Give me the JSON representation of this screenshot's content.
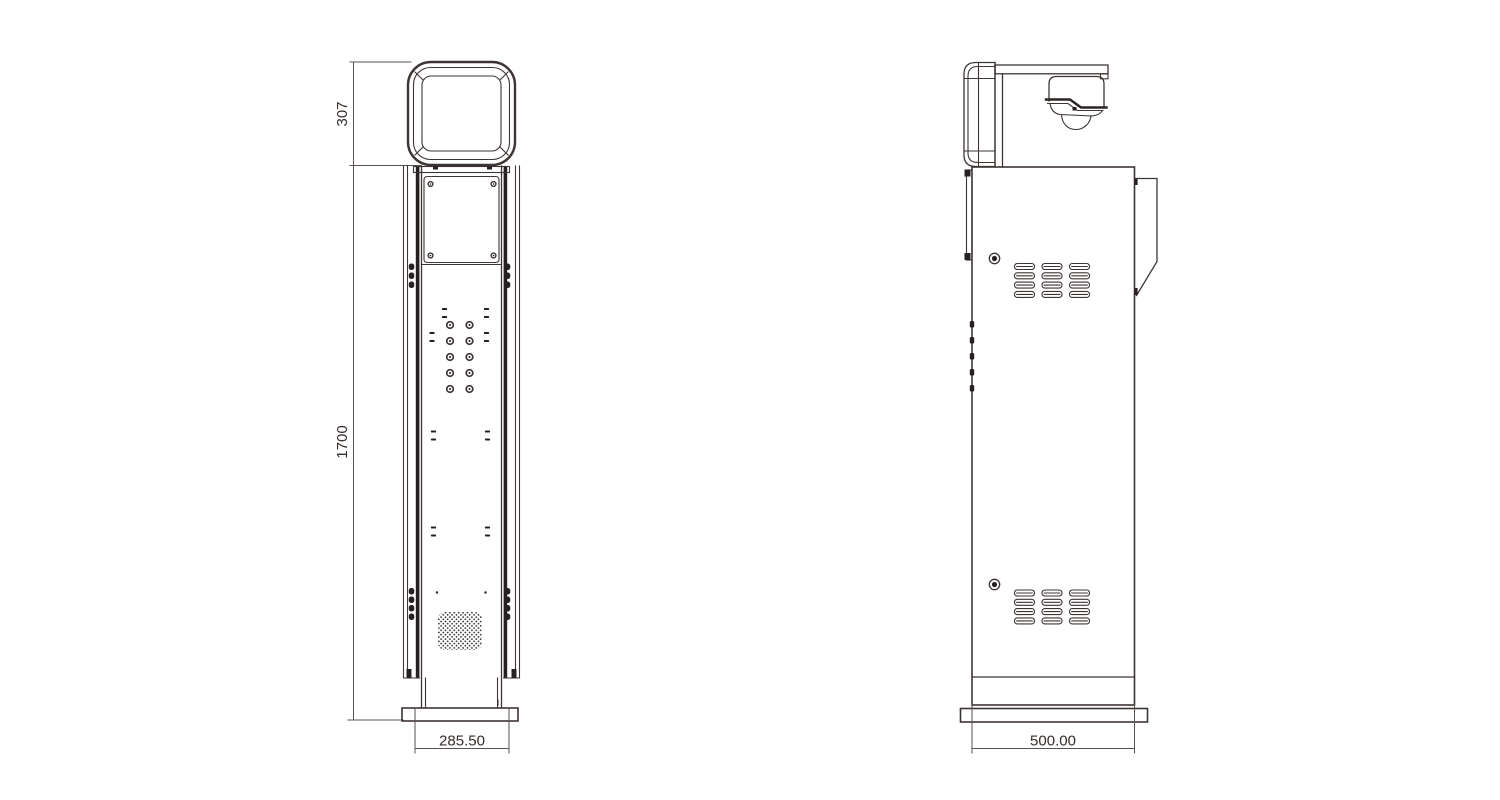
{
  "views": {
    "front": {
      "dimensions": {
        "head_height": "307",
        "column_height": "1700",
        "base_width": "285.50"
      }
    },
    "side": {
      "dimensions": {
        "base_depth": "500.00"
      }
    }
  },
  "colors": {
    "line": "#3d3533",
    "ink": "#262020",
    "dimension_line": "#5a5250",
    "background": "#ffffff"
  }
}
